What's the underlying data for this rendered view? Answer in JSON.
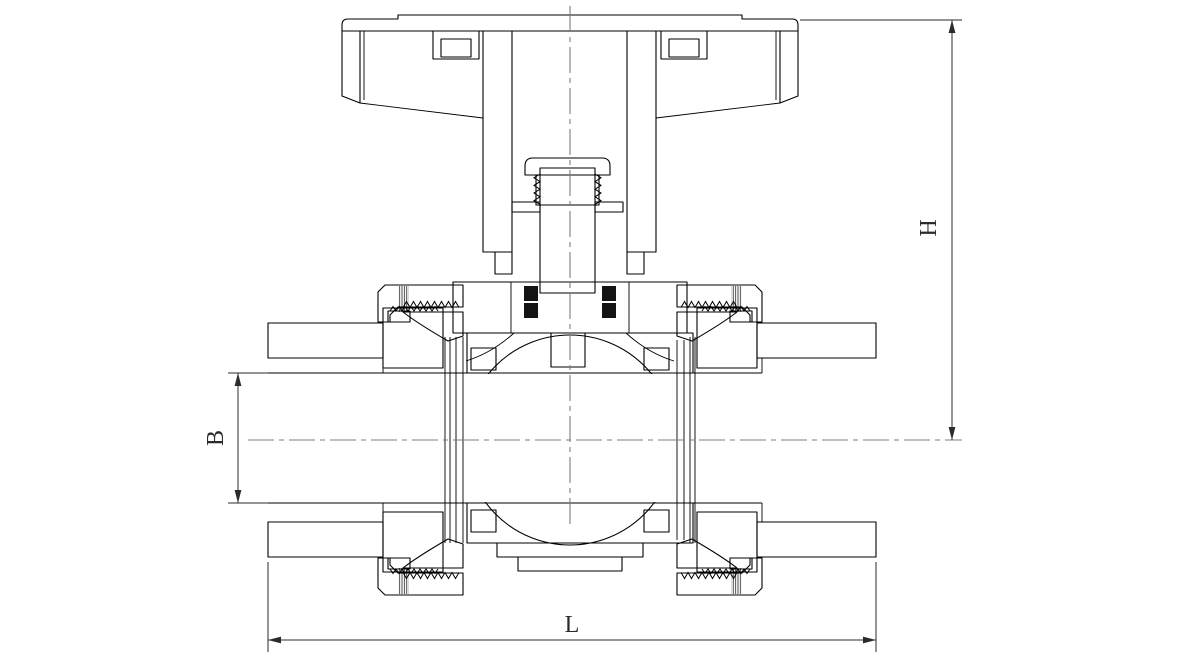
{
  "drawing": {
    "labels": {
      "height": "H",
      "bore": "B",
      "length": "L"
    }
  },
  "colors": {
    "background": "#ffffff",
    "line": "#000000",
    "dimension": "#2b2b2b",
    "centerline": "#7d7d7d",
    "seal": "#141414"
  }
}
